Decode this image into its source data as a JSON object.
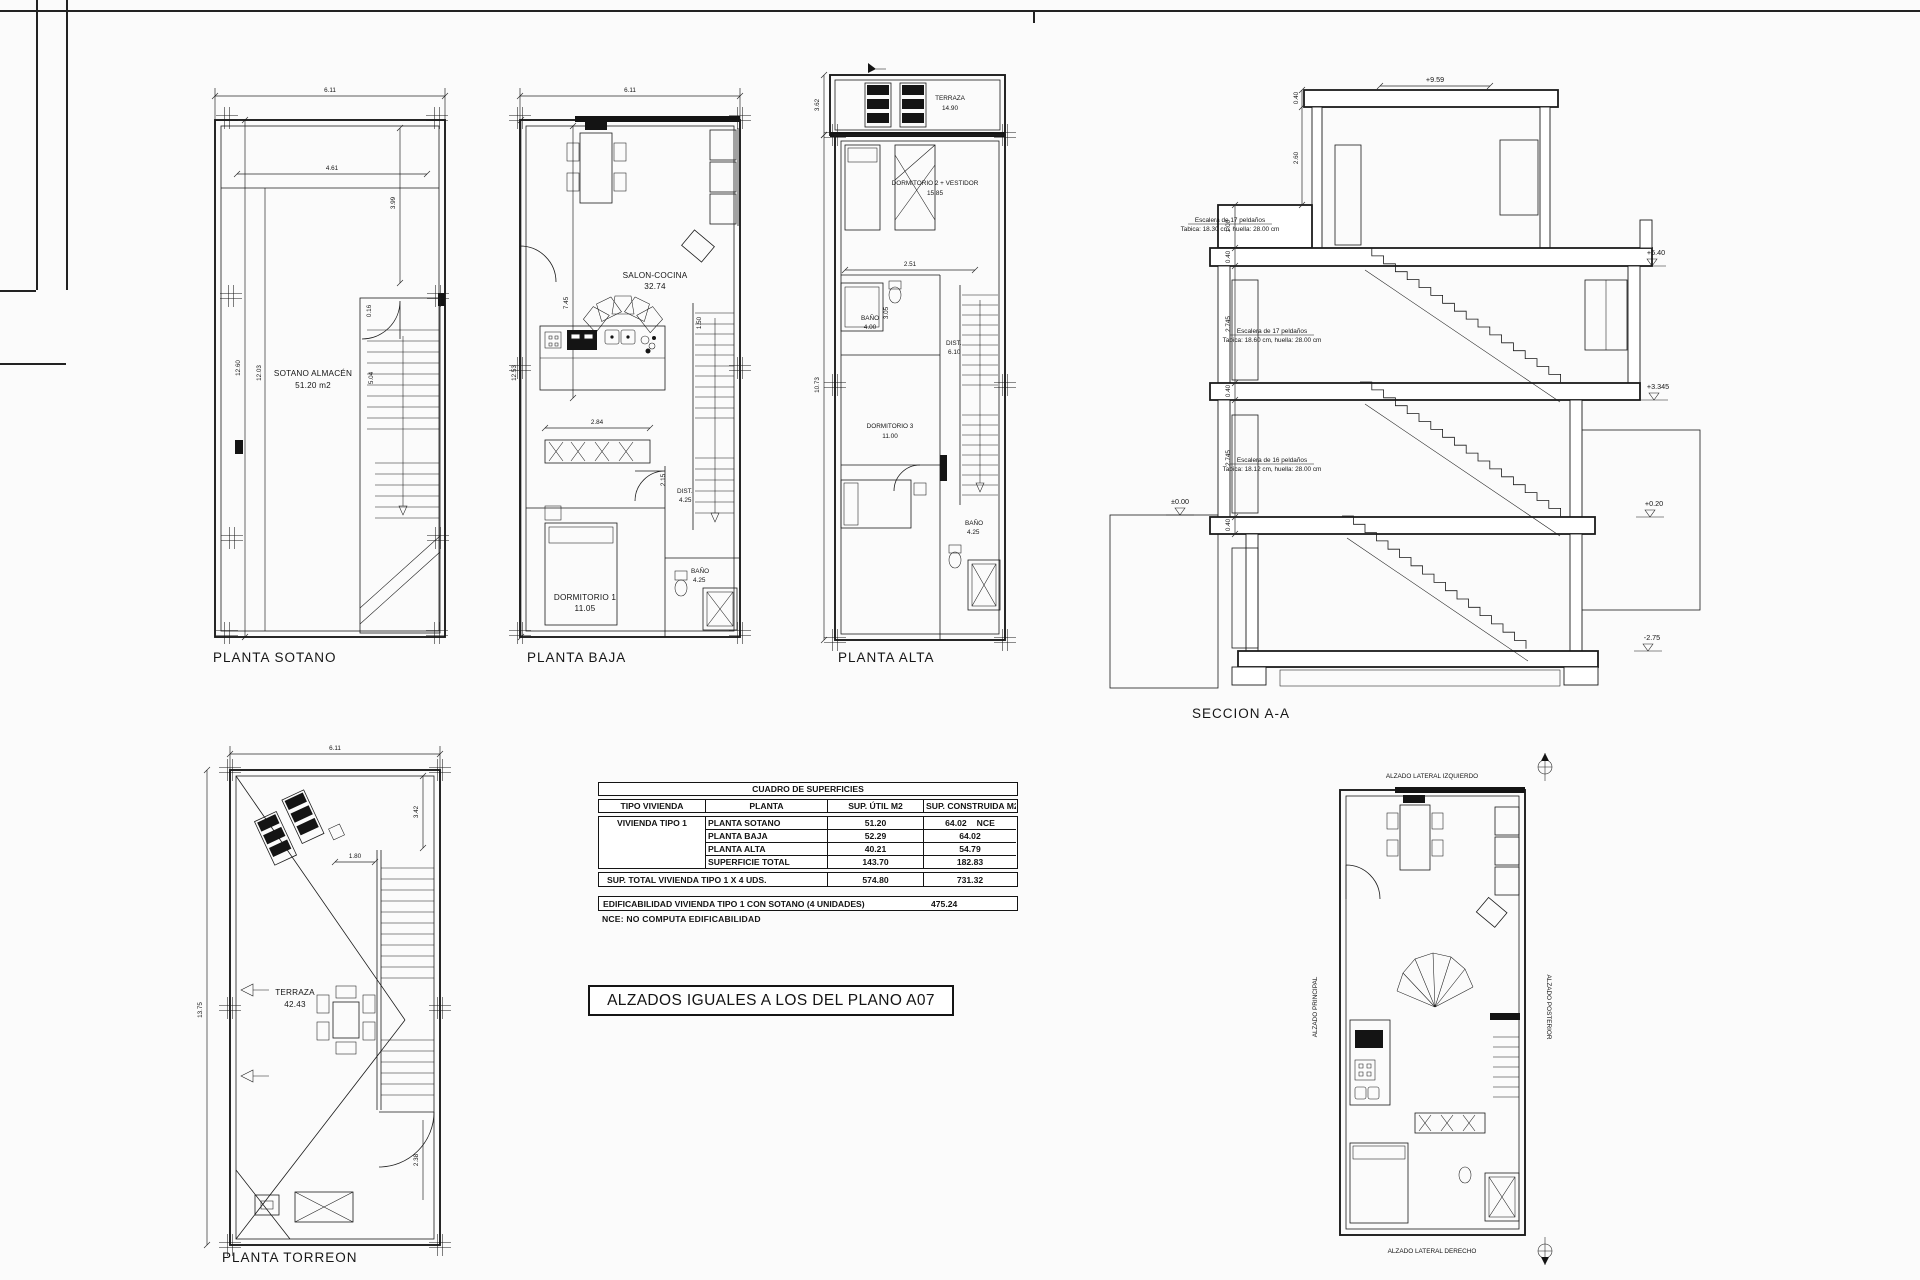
{
  "plans": {
    "sotano": {
      "title": "PLANTA SOTANO",
      "room": {
        "name": "SOTANO ALMACÉN",
        "area": "51.20 m2"
      },
      "dims": {
        "w": "6.11",
        "wi": "4.61",
        "h": "12.60",
        "hi": "12.03",
        "r": "3.99",
        "s1": "5.04",
        "s2": "0.16"
      }
    },
    "baja": {
      "title": "PLANTA BAJA",
      "rooms": {
        "salon": {
          "name": "SALON-COCINA",
          "area": "32.74"
        },
        "dorm1": {
          "name": "DORMITORIO 1",
          "area": "11.05"
        },
        "bano": {
          "name": "BAÑO",
          "area": "4.25"
        },
        "dist": {
          "name": "DIST.",
          "area": "4.25"
        }
      },
      "dims": {
        "w": "6.11",
        "h": "12.53",
        "salon": "7.45",
        "armario": "2.84",
        "puerta": "2.15",
        "stair": "1.50"
      }
    },
    "alta": {
      "title": "PLANTA ALTA",
      "rooms": {
        "terraza": {
          "name": "TERRAZA",
          "area": "14.90"
        },
        "dorm2": {
          "name": "DORMITORIO 2 + VESTIDOR",
          "area": "15.85"
        },
        "bano1": {
          "name": "BAÑO",
          "area": "4.00"
        },
        "dist": {
          "name": "DIST.",
          "area": "6.10"
        },
        "dorm3": {
          "name": "DORMITORIO 3",
          "area": "11.00"
        },
        "bano2": {
          "name": "BAÑO",
          "area": "4.25"
        }
      },
      "dims": {
        "terraza": "3.62",
        "h": "10.73",
        "d1": "2.51",
        "d2": "3.05"
      }
    },
    "torreon": {
      "title": "PLANTA TORREON",
      "room": {
        "name": "TERRAZA",
        "area": "42.43"
      },
      "dims": {
        "w": "6.11",
        "h": "13.75",
        "d1": "3.42",
        "d2": "1.80",
        "d3": "2.38"
      }
    }
  },
  "seccion": {
    "title": "SECCION A-A",
    "stairs": [
      {
        "l1": "Escalera de 17 peldaños",
        "l2": "Tabica: 18.30 cm, huella: 28.00 cm"
      },
      {
        "l1": "Escalera de 17 peldaños",
        "l2": "Tabica: 18.60 cm, huella: 28.00 cm"
      },
      {
        "l1": "Escalera de 16 peldaños",
        "l2": "Tabica: 18.12 cm, huella: 28.00 cm"
      }
    ],
    "levels": {
      "top": "+9.59",
      "f2": "+6.40",
      "f1": "+3.345",
      "f0": "+0.20",
      "fb": "-2.75",
      "grade": "±0.00"
    },
    "chain": [
      "0.40",
      "2.60",
      "1.00",
      "0.40",
      "2.745",
      "0.40",
      "2.745",
      "0.40"
    ]
  },
  "surfaces_table": {
    "title": "CUADRO DE SUPERFICIES",
    "headers": {
      "tipo": "TIPO VIVIENDA",
      "planta": "PLANTA",
      "util": "SUP. ÚTIL M2",
      "construida": "SUP. CONSTRUIDA M2"
    },
    "tipo_value": "VIVIENDA TIPO 1",
    "rows": [
      {
        "planta": "PLANTA SOTANO",
        "util": "51.20",
        "construida": "64.02",
        "tag": "NCE"
      },
      {
        "planta": "PLANTA BAJA",
        "util": "52.29",
        "construida": "64.02",
        "tag": ""
      },
      {
        "planta": "PLANTA ALTA",
        "util": "40.21",
        "construida": "54.79",
        "tag": ""
      },
      {
        "planta": "SUPERFICIE TOTAL",
        "util": "143.70",
        "construida": "182.83",
        "tag": ""
      }
    ],
    "total": {
      "label": "SUP. TOTAL VIVIENDA TIPO 1 X 4 UDS.",
      "util": "574.80",
      "construida": "731.32"
    },
    "edificabilidad": {
      "label": "EDIFICABILIDAD VIVIENDA TIPO 1 CON SOTANO (4 UNIDADES)",
      "value": "475.24"
    },
    "nce_note": "NCE:  NO COMPUTA EDIFICABILIDAD"
  },
  "notes": {
    "alzados_box": "ALZADOS IGUALES A LOS DEL PLANO A07"
  },
  "alzados": {
    "top": "ALZADO LATERAL IZQUIERDO",
    "left": "ALZADO PRINCIPAL",
    "right": "ALZADO POSTERIOR",
    "bottom": "ALZADO LATERAL DERECHO"
  }
}
